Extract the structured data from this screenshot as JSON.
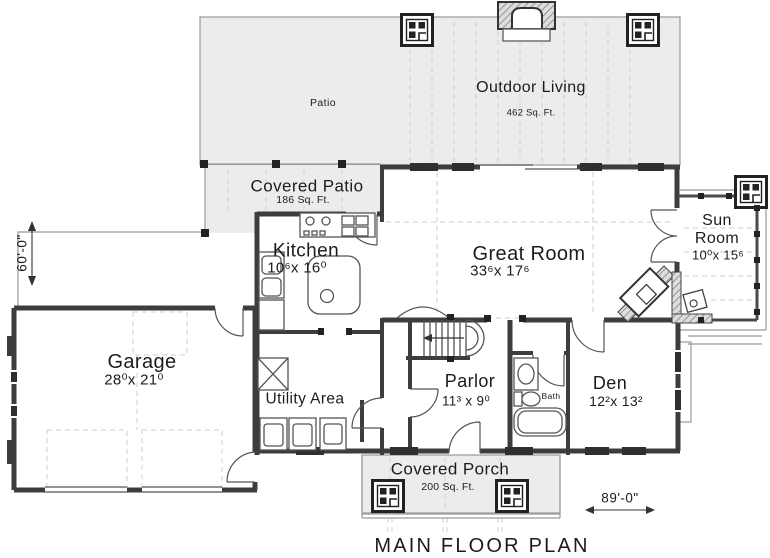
{
  "title": "MAIN FLOOR PLAN",
  "colors": {
    "wall": "#3d3d3d",
    "text": "#1c1c1c",
    "patio_fill": "#ececec"
  },
  "dimensions": {
    "height_label": "60'-0\"",
    "width_label": "89'-0\""
  },
  "rooms": {
    "patio": {
      "name": "Patio"
    },
    "outdoor_living": {
      "name": "Outdoor Living",
      "area": "462 Sq. Ft."
    },
    "covered_patio": {
      "name": "Covered Patio",
      "area": "186 Sq. Ft."
    },
    "kitchen": {
      "name": "Kitchen",
      "dims": "10⁶x 16⁰"
    },
    "great_room": {
      "name": "Great Room",
      "dims": "33⁶x 17⁶"
    },
    "sun_room": {
      "name": "Sun Room",
      "dims": "10⁰x 15⁶"
    },
    "garage": {
      "name": "Garage",
      "dims": "28⁰x 21⁰"
    },
    "utility": {
      "name": "Utility Area"
    },
    "parlor": {
      "name": "Parlor",
      "dims": "11³ x 9⁰"
    },
    "bath": {
      "name": "Bath"
    },
    "den": {
      "name": "Den",
      "dims": "12²x 13²"
    },
    "covered_porch": {
      "name": "Covered Porch",
      "area": "200 Sq. Ft."
    }
  }
}
